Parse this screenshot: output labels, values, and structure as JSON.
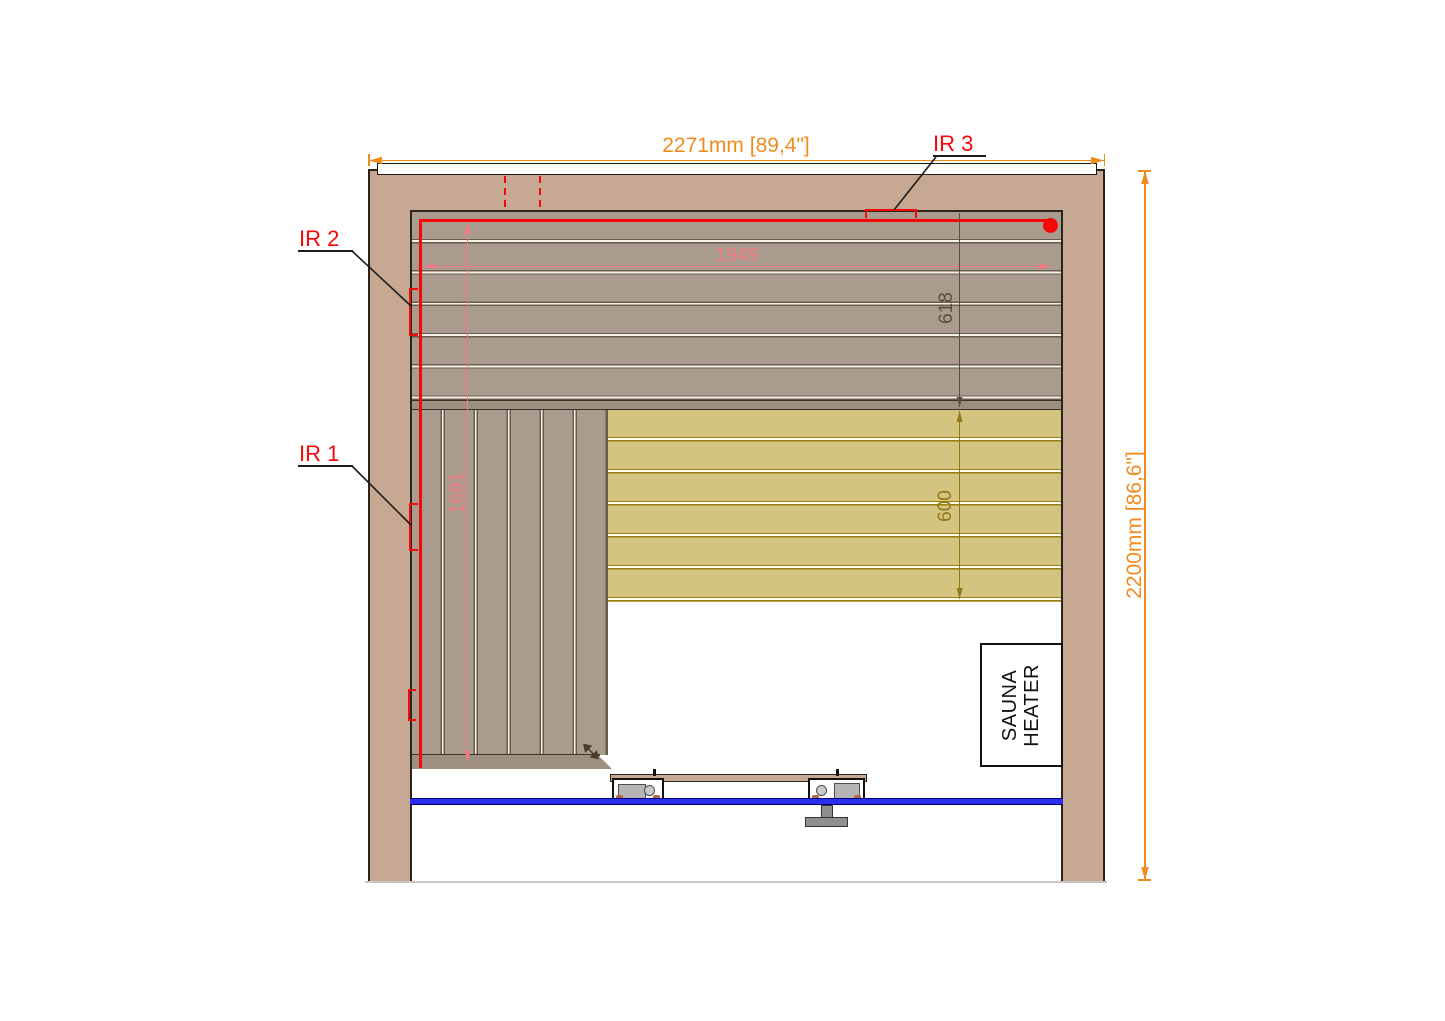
{
  "dimensions": {
    "overall_width": "2271mm [89,4\"]",
    "overall_height": "2200mm [86,6\"]",
    "inner_width": "1949",
    "left_panel_height": "1681",
    "upper_band_height": "618",
    "backrest_height": "600"
  },
  "annotations": {
    "ir1": "IR 1",
    "ir2": "IR 2",
    "ir3": "IR 3"
  },
  "heater": {
    "line1": "SAUNA",
    "line2": "HEATER"
  },
  "colors": {
    "wall": "#c7a892",
    "plank_gray": "#a99b8d",
    "plank_yellow": "#d3c47f",
    "dimension_orange": "#f08c1e",
    "annotation_red": "#f70808",
    "annotation_pink": "#f4787f",
    "dim_olive": "#5a4e3e",
    "dim_gold": "#917716",
    "rail_blue": "#2d2df0"
  }
}
